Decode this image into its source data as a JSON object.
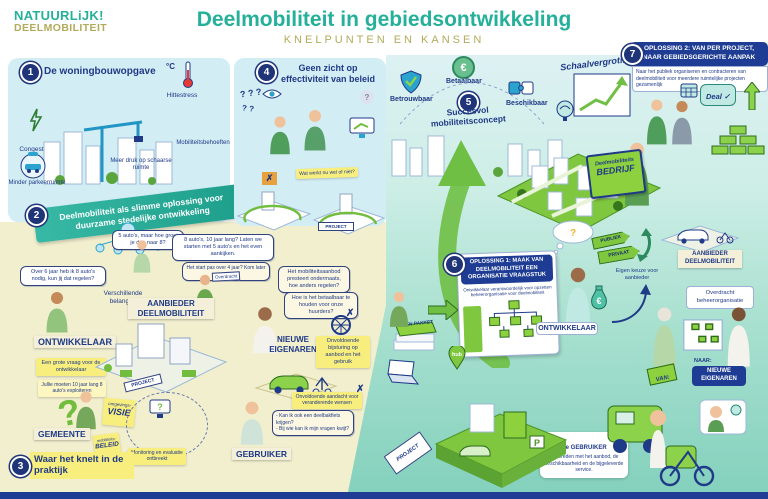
{
  "header": {
    "logo_line1": "NATUURLiJK!",
    "logo_line2": "DEELMOBILITEIT",
    "title": "Deelmobiliteit in gebiedsontwikkeling",
    "subtitle": "KNELPUNTEN EN KANSEN"
  },
  "left": {
    "p1": {
      "num": "1",
      "title": "De woningbouwopgave",
      "congestie": "Congestie",
      "temp": "°C",
      "hittestress": "Hittestress",
      "mobiliteitsbehoeften": "Mobiliteitsbehoeften",
      "druk": "Meer druk op schaarse ruimte",
      "parkeer": "Minder parkeerruimte"
    },
    "p2": {
      "num": "2",
      "banner": "Deelmobiliteit als slimme oplossing voor duurzame stedelijke ontwikkeling"
    },
    "bubble_over6jaar": "Over 6 jaar heb ik 8 auto's nodig, kun jij dat regelen?",
    "bubble_5autos": "5 auto's, maar hoe groei je dan naar 8?",
    "bubble_8autos": "8 auto's, 10 jaar lang? Laten we starten met 5 auto's en het even aankijken.",
    "bubble_start": "Het start pas over 4 jaar? Kom later maar terug!",
    "verschillende": "Verschillende belangen",
    "overdracht": "Overdracht",
    "ontwikkelaar": "ONTWIKKELAAR",
    "aanbieder": "AANBIEDER DEELMOBILITEIT",
    "note_grote_vraag": "Een grote vraag voor de ontwikkelaar",
    "note_jullie": "Jullie moeten 10 jaar lang 8 auto's exploiteren",
    "qmark": "?",
    "gemeente": "GEMEENTE",
    "sticky_visie_top": "omgevings-",
    "sticky_visie_main": "VISIE",
    "sticky_beleid_top": "mobiliteits-",
    "sticky_beleid_main": "BELEID",
    "note_monitoring": "Monitoring en evaluatie ontbreekt",
    "p3": {
      "num": "3",
      "title": "Waar het knelt in de praktijk"
    },
    "project_sign": "PROJECT"
  },
  "middle": {
    "p4": {
      "num": "4",
      "title": "Geen zicht op effectiviteit van beleid",
      "qmarks1": "? ? ?",
      "qmarks2": "? ?",
      "qmark_gray": "?"
    },
    "note_watwerkt": "Wat werkt nu wel of niet?",
    "x_mark": "✗",
    "project_sign": "PROJECT",
    "bubble_aanbod": "Het mobiliteitsaanbod presteert ondermaats, hoe anders regelen?",
    "bubble_betaalbaar": "Hoe is het betaalbaar te houden voor onze huurders?",
    "nieuwe_eigenaren": "NIEUWE EIGENAREN",
    "note_bijsturing": "Onvoldoende bijsturing op aanbod en het gebruik",
    "note_aandacht": "Onvoldoende aandacht voor veranderende wensen",
    "bubble_vraag1": "- Kan ik ook een deelbakfiets krijgen?",
    "bubble_vraag2": "- Bij wie kan ik mijn vragen kwijt?",
    "gebruiker": "GEBRUIKER"
  },
  "right": {
    "betrouwbaar": "Betrouwbaar",
    "betaalbaar": "Betaalbaar",
    "beschikbaar": "Beschikbaar",
    "euro": "€",
    "p5": {
      "num": "5",
      "title": "Succesvol mobiliteitsconcept"
    },
    "schaalvergroting": "Schaalvergroting",
    "p7": {
      "num": "7",
      "title_l1": "OPLOSSING 2: VAN PER PROJECT,",
      "title_l2": "NAAR GEBIEDSGERICHTE AANPAK",
      "sub": "Naar het publiek organiseren en contracteren van deelmobiliteit voor meerdere ruimtelijke projecten gezamenlijk"
    },
    "deal": "Deal ✓",
    "folder_l1": "Deelmobiliteits",
    "folder_l2": "BEDRIJF",
    "p6": {
      "num": "6",
      "title_l1": "OPLOSSING 1: MAAK VAN",
      "title_l2": "DEELMOBILITEIT EEN",
      "title_l3": "ORGANISATIE VRAAGSTUK",
      "sub": "Ontwikkelaar verantwoordelijk voor opzetten beheerorganisatie voor deelmobiliteit"
    },
    "ontwikkelaar": "ONTWIKKELAAR",
    "publiek": "PUBLIEK",
    "privaat": "PRIVAAT",
    "eigen_keuze": "Eigen keuze voor aanbieder",
    "aanbieder": "AANBIEDER DEELMOBILITEIT",
    "overdracht": "Overdracht beheerorganisatie",
    "van": "VAN:",
    "naar": "NAAR:",
    "nieuwe_eigenaren": "NIEUWE EIGENAREN",
    "gebruiker_bold": "De GEBRUIKER",
    "gebruiker_rest": "is tevreden met het aanbod, de beschikbaarheid en de bijgeleverde service.",
    "project_tag": "PROJECT",
    "eisen": "EISEN PAKKET",
    "hub": "hub",
    "parking": "P"
  }
}
